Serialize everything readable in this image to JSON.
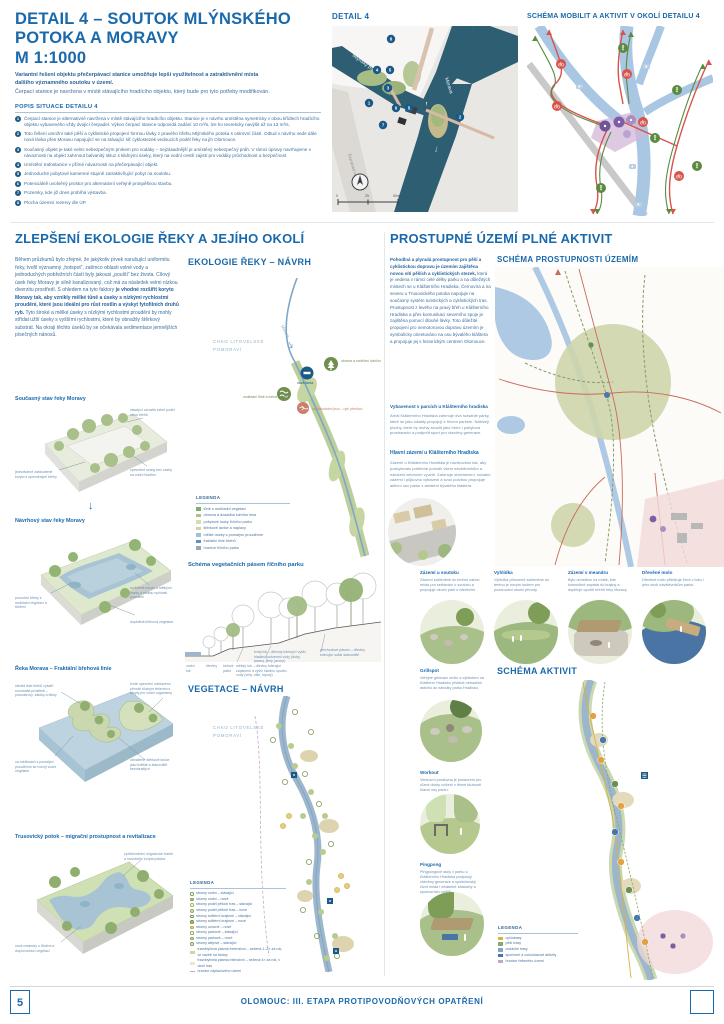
{
  "header": {
    "title_l1": "DETAIL 4 – SOUTOK MLÝNSKÉHO",
    "title_l2": "POTOKA A MORAVY",
    "title_l3": "M 1:1000",
    "lead_bold": "Variantní řešení objektu přečerpávací stanice umožňuje lepší využitelnost a zatraktivnění místa dalšího významného soutoku v území.",
    "lead": "Čerpací stanice je navržena v místě stávajícího hradícího objektu, který bude pro tyto potřeby modifikován.",
    "list_title": "POPIS SITUACE DETAILU 4",
    "items": [
      {
        "num": "1",
        "text": "Čerpací stanice je alternativně navržena v místě stávajícího hradícího objektu. Stanice je v návrhu umístěna symetricky v obou křídlech hradícího objektu vybaveného vždy dvojicí čerpadel. Výkon čerpací stanice odpovídá zadání 10 m³/s, lze ho teoreticky navýšit až na 13 m³/s."
      },
      {
        "num": "2",
        "text": "Toto řešení umožní také pěší a cyklistické propojení formou lávky z pravého břehu Mlýnského potoka s ostrovní částí. Odtud v návrhu vede dále nová lávka přes Moravu napojující se na stávající síť cyklostezek vedoucích podél řeky na jih Olomouce."
      },
      {
        "num": "3",
        "text": "Současný objekt je také velmi nebezpečným prvkem pro vodáky – nejzásadnější je umístěný nebezpečný práh. V rámci úpravy navrhujeme v návaznosti na objekt zahrnout balvanitý skluz s klidnými úseky, který na vodní cestě zajistí pro vodáky průchodnost a bezpečnost."
      },
      {
        "num": "4",
        "text": "Umístění trafostanice v přímé návaznosti na přečerpávající objekt."
      },
      {
        "num": "5",
        "text": "Jednoduché pobytové kamenné stupně zatraktivňující pobyt na soutoku."
      },
      {
        "num": "6",
        "text": "Potenciálně uvolněný prostor pro alternativní veřejně prospěšnou stavbu."
      },
      {
        "num": "7",
        "text": "Pozemky, kde již dnes probíhá výstavba."
      },
      {
        "num": "8",
        "text": "Plocha územní rezervy dle ÚP."
      }
    ]
  },
  "detail_map": {
    "title": "DETAIL 4",
    "label_potok": "Mlýnský potok",
    "label_morava": "Morava",
    "label_street": "Švýcarské nábřeží",
    "scale_0": "0",
    "scale_25": "25",
    "scale_50": "50m",
    "markers": [
      "1",
      "2",
      "3",
      "4",
      "5",
      "6",
      "7",
      "8"
    ]
  },
  "mobility_map": {
    "title": "SCHÉMA MOBILIT A AKTIVIT V OKOLÍ DETAILU 4"
  },
  "ecology": {
    "heading": "ZLEPŠENÍ EKOLOGIE ŘEKY A JEJÍHO OKOLÍ",
    "p1": "Během průzkumů bylo zřejmé, že jakýkoliv prvek narušující uniformitu řeky, tvořil významný „hotspot“, zatímco oblasti volné vody a jednoduchých pobřežních částí byly jakousi „pouští“ bez života. Cílový úsek řeky Moravy je silně kanalizovaný, což má za následek velmi nízkou diverzitu prostředí. S ohledem na tyto faktory ",
    "p_bold": "je vhodné rozšířit koryto Moravy tak, aby vznikly mělké tůně a úseky s nízkými rychlostmi proudění, které jsou ideální pro růst rostlin a výskyt fytofilních druhů ryb.",
    "p2": " Tyto široké a mělké úseky s nízkými rychlostmi proudění by mohly střídat užší úseky s vyššími rychlostmi, které by obnažily štěrkový substrát. Na okraji těchto úseků by se očekávala sedimentace jemnějších písečných nánosů.",
    "diag1": {
      "title": "Současný stav řeky Moravy",
      "a1": "stávající vzrostlá zeleň podél obou břehů",
      "a2": "jednotvárné zahloubené koryto s opevněnými břehy",
      "a3": "zpevněné svahy bez vazby na vodní hladinu"
    },
    "diag2": {
      "title": "Návrhový stav řeky Moravy",
      "a1": "pozvolné břehy s mokřadní vegetací a tůněmi",
      "a2": "rozšířené koryto s mělkými úseky a nízkou rychlostí proudění",
      "a3": "doplněná břehová vegetace"
    },
    "diag3": {
      "title": "Řeka Morava – Fraktální břehová linie",
      "a1": "členitá linie břehů vytváří rozmanitá prostředí – poloostrovy, zátoky a tišiny",
      "a2": "tvrdé opevnění nahrazeno přírodě blízkým řešením s úkryty pro vodní organismy",
      "a3": "na mělčinách s pomalým prouděním se rozvíjí vodní vegetace",
      "a4": "obnažené štěrkové lavice jako trdliště a stanoviště bezobratlých"
    },
    "diag4": {
      "title": "Trusovický potok – migrační prostupnost a revitalizace",
      "a1": "zprůchodnění migračních bariér a rozvolnění koryta potoka",
      "a2": "nové meandry s tůněmi a doprovodnou vegetací"
    }
  },
  "ecology_map": {
    "heading": "EKOLOGIE ŘEKY – NÁVRH",
    "chko": "CHKO LITOVELSKÉ POMORAVÍ",
    "river_label": "Morava",
    "badge1": "obnova a rozšíření lužního lesa",
    "badge_node": "nová lávka",
    "badge2": "mokřadní tůně a mrtvá ramena",
    "badge3": "zprůchodnění jezu – rybí přechod",
    "legend_title": "LEGENDA",
    "legend": [
      {
        "label": "tůně s mokřadní vegetací",
        "color": "#7fae6a"
      },
      {
        "label": "obnova a dosadba lužního lesa",
        "color": "#a9c487"
      },
      {
        "label": "pobytové louky říčního parku",
        "color": "#cfe0ae"
      },
      {
        "label": "štěrkové lavice a náplavy",
        "color": "#d8cfa6"
      },
      {
        "label": "mělké úseky s pomalým prouděním",
        "color": "#9cc3d6"
      },
      {
        "label": "fraktální linie břehů",
        "color": "#5f93b8"
      },
      {
        "label": "hranice říčního parku",
        "color": "#9aa7b0"
      }
    ]
  },
  "veg_section": {
    "title": "Schéma vegetačních pásem říčního parku",
    "left1": "vodní tok",
    "left2": "dřeviny",
    "left3": "keřové patro",
    "ann_mekky": "měkký luh – dřeviny tolerující zaplavení a vyšší hladinu spodní vody (vrby, olše, topoly)",
    "ann_tvrdy": "tvrdý luh – dřeviny tolerující vyšší hladinu podzemní vody (duby, jasany, jilmy, javory)",
    "ann_prech": "přechodové pásmo – dřeviny tolerující sušší stanoviště"
  },
  "veg_map": {
    "heading": "VEGETACE – NÁVRH",
    "chko": "CHKO LITOVELSKÉ POMORAVÍ",
    "legend_title": "LEGENDA",
    "legend": [
      {
        "label": "stromy vodní – stávající"
      },
      {
        "label": "stromy vodní – nové"
      },
      {
        "label": "stromy podél pěších tras – stávající"
      },
      {
        "label": "stromy podél pěších tras – nové"
      },
      {
        "label": "stromy solitérní krajinné – stávající"
      },
      {
        "label": "stromy solitérní krajinné – nové"
      },
      {
        "label": "stromy ovocné – nové"
      },
      {
        "label": "stromy parkové – stávající"
      },
      {
        "label": "stromy parkové – nové"
      },
      {
        "label": "stromy alejové – stávající"
      },
      {
        "label": "travobylinná pásma extenzivní – sečená 1–2× za rok, ve vazbě na biotop"
      },
      {
        "label": "travobylinná pásma intenzivní – sečená 4× za rok, v okolí tras"
      },
      {
        "label": "hranice záplavového území"
      }
    ]
  },
  "prostupnost": {
    "heading": "PROSTUPNÉ ÚZEMÍ PLNÉ AKTIVIT",
    "p_bold": "Pohodlná a plynulá prostupnost pro pěší a cyklistickou dopravu je územím zajištěna novou sítí pěších a cyklistických stezek,",
    "p": " která je vedena v rámci celé délky parku a na důležitých místech se u Klášterního Hradiska, Černovíra a na severu u Trusovického potoka napojuje na současný systém turistických a cyklistických tras. Prostupnost z levého na pravý břeh u Klášterního Hradiska a přes komunikaci severního spoje je zajištěna pomocí dlouhé lávky. Toto důležité propojení pro nemotorovou dopravu územím je symbolicky orientováno na osu bývalého kláštera a propojuje jej s historickým centrem Olomouce.",
    "map_heading": "SCHÉMA PROSTUPNOSTI ÚZEMÍM",
    "sub1_title": "Vybavenost v parcích u Klášterního hradiska",
    "sub1_text": "Areál Klášterního Hradiska zahrnuje dva rozsáhlé parky, které se jako lokality propojují s říčním parkem. Nabízejí plochy, které by mohly sloužit jako herní i pobytová prostranství a podpořit sport pro všechny generace.",
    "sub2_title": "Hlavní zázemí u Klášterního Hradiska",
    "sub2_text": "Zázemí u Klášterního Hradiska je navrhováno tak, aby poskytovalo potřebné pohodlí všem návštěvníkům a nabízelo celoroční využití. Zahrnuje občerstvení, sociální zázemí i půjčovnu vybavení a svou polohou propojuje aktivní osu parku s areálem bývalého kláštera."
  },
  "vignettes": [
    {
      "title": "Zázemí u soutoku",
      "text": "Zázemí začleněné do terénu nabízí místa pro setkávání u soutoku a propojuje okolní park s nábřežím."
    },
    {
      "title": "Vyhlídka",
      "text": "Vyhlídka přirozeně začleněná do terénu je novým bodem pro pozorování okolní přírody."
    },
    {
      "title": "Zázemí v meandru",
      "text": "Bylo umístěno na místě, kde komunitně zapadá do krajiny a doplňuje využití břehů řeky Moravy."
    },
    {
      "title": "Dřevěné molo",
      "text": "Dřevěné molo přibližuje život v toku i jeho okolí návštěvníkům parku."
    }
  ],
  "activities": [
    {
      "title": "Grillspot",
      "text": "Veřejné grilovací místo s výhledem na Klášterní Hradisko přidává netradiční aktivitu do nabídky parku Hradisko."
    },
    {
      "title": "Workout",
      "text": "Venkovní posilovna je prostorem pro různé druhy cvičení v těsné blízkosti hlavní osy parku."
    },
    {
      "title": "Pingpong",
      "text": "Pingpongové stoly v parku u Klášterního Hradiska podporují všechny generace a společenský život místa i nedaleké zástavby a sportovních oddílů."
    }
  ],
  "aktivit_map": {
    "heading": "SCHÉMA AKTIVIT",
    "legend_title": "LEGENDA",
    "legend": [
      {
        "label": "cyklotrasy",
        "color": "#d9b23f"
      },
      {
        "label": "pěší trasy",
        "color": "#8aa86a"
      },
      {
        "label": "vodácké trasy",
        "color": "#7fa7c7"
      },
      {
        "label": "sportovní a volnočasové aktivity",
        "color": "#4977ad"
      },
      {
        "label": "hranice řešeného území",
        "color": "#c9a6c9"
      }
    ]
  },
  "footer": {
    "page_number": "5",
    "title": "OLOMOUC: III. ETAPA PROTIPOVODŇOVÝCH OPATŘENÍ"
  }
}
